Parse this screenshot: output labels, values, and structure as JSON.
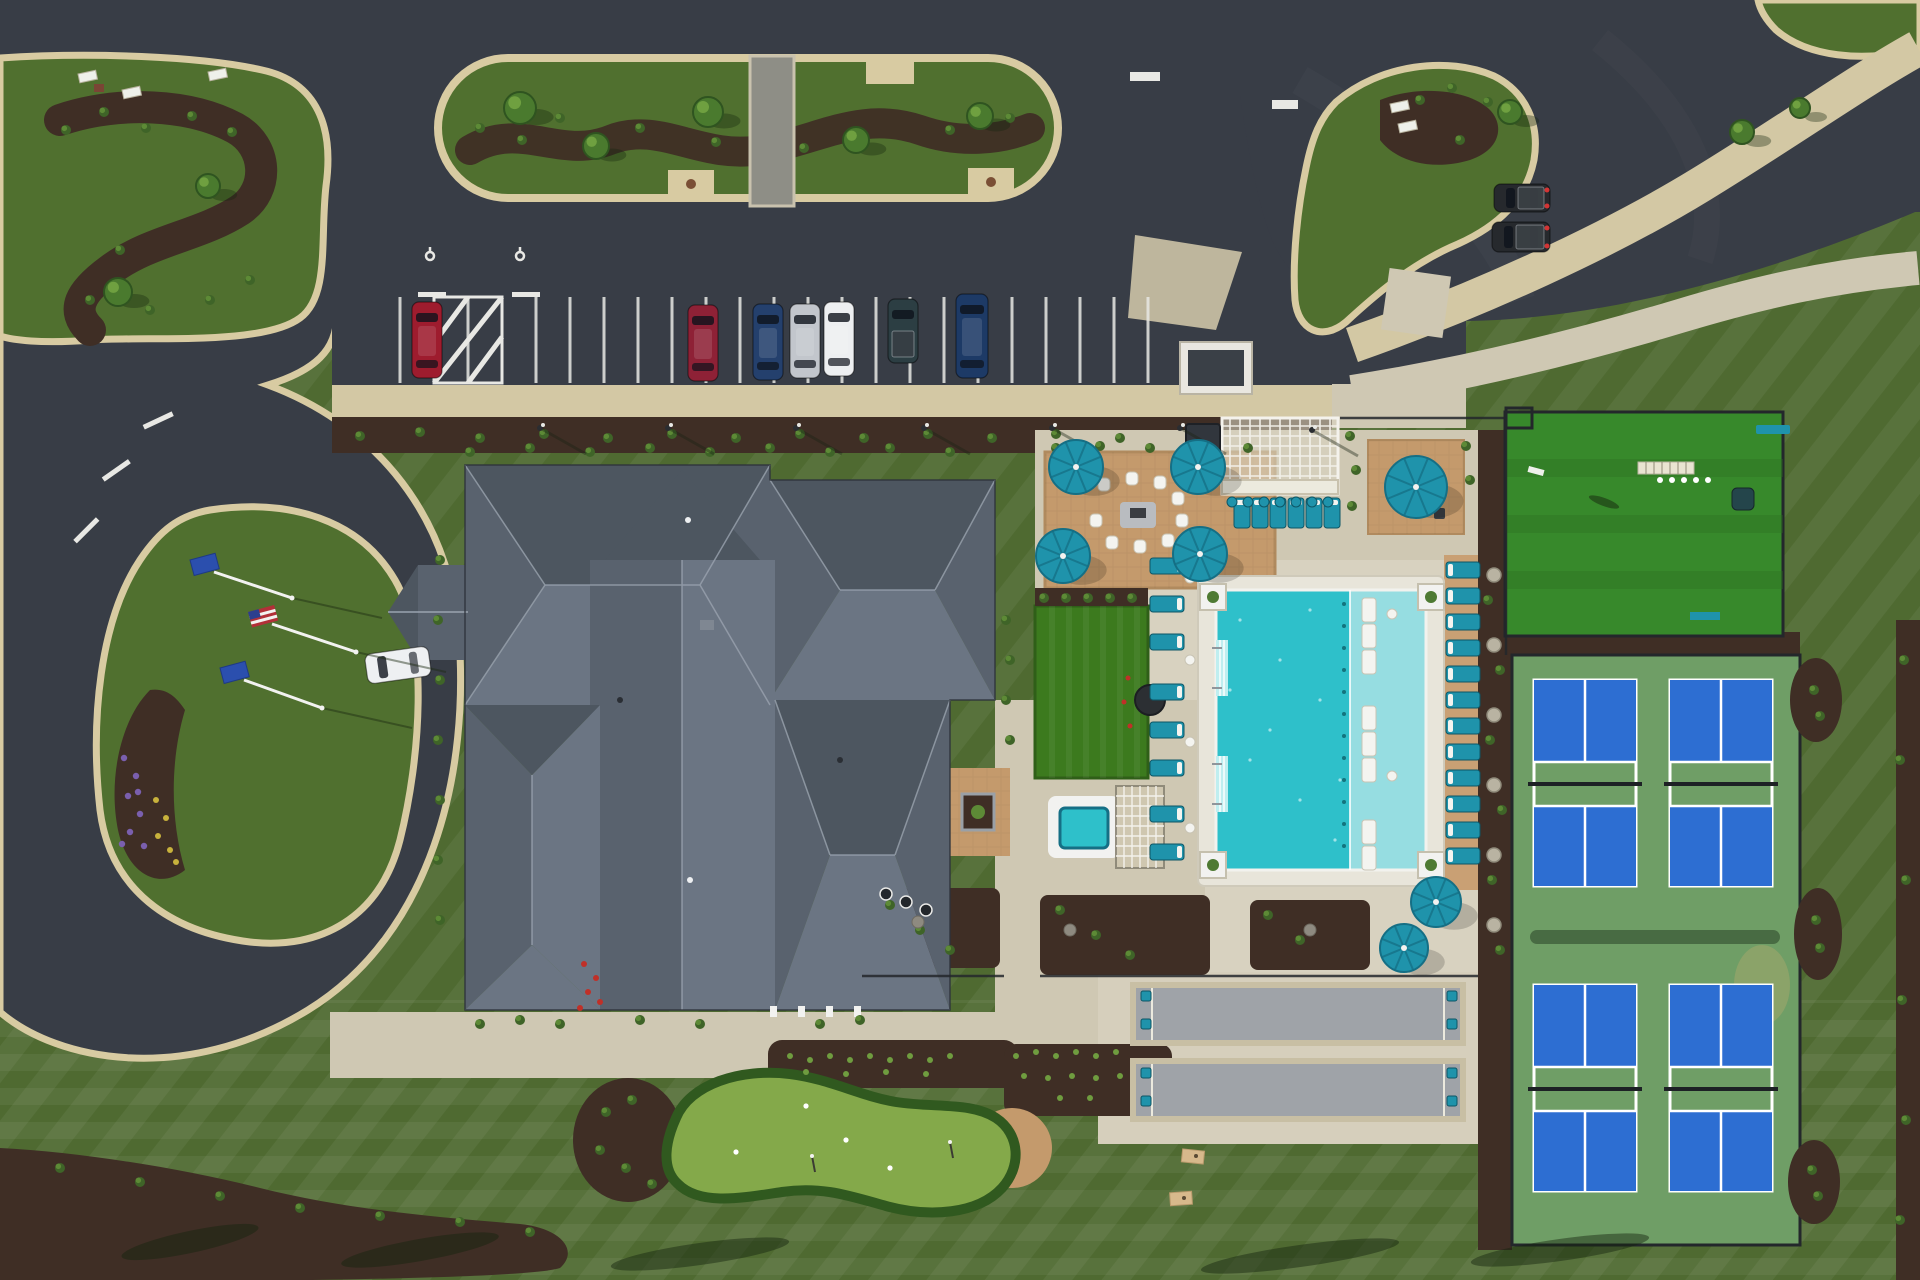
{
  "meta": {
    "title": "Aerial drone view of a community clubhouse campus with circular drive, parking lot, pool, pickleball courts, bocce courts and putting greens",
    "view": "top-down aerial photo"
  },
  "colors": {
    "lawn": "#4f6a31",
    "asphalt": "#383d46",
    "curb": "#d8cba2",
    "concrete": "#cfc8b3",
    "deck": "#e8e5da",
    "paver": "#c49a6c",
    "mulch": "#3f2e25",
    "roofN": "#4d5660",
    "roofS": "#6b7583",
    "roofSide": "#59626e",
    "roofEdge": "#2c313a",
    "ridge": "#9aa3af",
    "poolWater": "#2ec0ca",
    "poolShelf": "#96dde1",
    "teal": "#1f93ab",
    "tealDark": "#156f85",
    "courtBlue": "#2d6ed2",
    "courtGreen": "#6f9e66",
    "turf": "#37892b",
    "putting": "#84a94a",
    "puttingFringe": "#30591f",
    "bocce": "#9fa3a8",
    "fence": "#23272b",
    "white": "#f2f2f0",
    "flagBlue": "#2b4fae",
    "flagRed": "#b23038"
  },
  "counts": {
    "parked_cars": 7,
    "loose_vehicles": 3,
    "parking_stalls": 23,
    "accessible_stalls": 2,
    "flag_poles": 3,
    "patio_umbrellas": 7,
    "fire_pit_chairs": 9,
    "bar_stools": 7,
    "loungers_west": 8,
    "loungers_north": 6,
    "loungers_east": 12,
    "in_pool_loungers": 8,
    "pickleball_courts": 4,
    "bocce_courts": 2,
    "bocce_chairs": 8,
    "putting_greens": 2,
    "cornhole_boards": 2,
    "hot_tubs": 1
  },
  "inventory": {
    "parking": {
      "stalls": {
        "x0": 400,
        "pitch": 34,
        "count": 23,
        "y1": 297,
        "y2": 383,
        "hatch": [
          434,
          502
        ]
      }
    },
    "cars": [
      {
        "name": "car-red",
        "x": 412,
        "y": 302,
        "w": 30,
        "h": 76,
        "color": "#9e1c2e"
      },
      {
        "name": "car-maroon",
        "x": 688,
        "y": 305,
        "w": 30,
        "h": 76,
        "color": "#8e2136"
      },
      {
        "name": "car-navy",
        "x": 753,
        "y": 304,
        "w": 30,
        "h": 76,
        "color": "#24406d"
      },
      {
        "name": "car-silver",
        "x": 790,
        "y": 304,
        "w": 30,
        "h": 74,
        "color": "#c2c6cc"
      },
      {
        "name": "car-white",
        "x": 824,
        "y": 302,
        "w": 30,
        "h": 74,
        "color": "#edeff1"
      },
      {
        "name": "pickup-dark-teal",
        "x": 888,
        "y": 299,
        "w": 30,
        "h": 64,
        "color": "#2c3e43",
        "bed": true
      },
      {
        "name": "suv-navy",
        "x": 956,
        "y": 294,
        "w": 32,
        "h": 84,
        "color": "#1d3a66"
      }
    ],
    "loose_vehicles": [
      {
        "name": "car-white-driveway",
        "x": 366,
        "y": 650,
        "w": 64,
        "h": 30,
        "color": "#eef0f2",
        "rot": -8
      },
      {
        "name": "truck-dark-1",
        "x": 1494,
        "y": 184,
        "w": 56,
        "h": 28,
        "color": "#26292d",
        "tail": true
      },
      {
        "name": "truck-dark-2",
        "x": 1492,
        "y": 222,
        "w": 58,
        "h": 30,
        "color": "#26292d",
        "tail": true
      }
    ],
    "umbrellas": [
      {
        "cx": 1076,
        "cy": 467,
        "r": 27
      },
      {
        "cx": 1198,
        "cy": 467,
        "r": 27
      },
      {
        "cx": 1063,
        "cy": 556,
        "r": 27
      },
      {
        "cx": 1200,
        "cy": 554,
        "r": 27
      },
      {
        "cx": 1416,
        "cy": 487,
        "r": 31
      },
      {
        "cx": 1436,
        "cy": 902,
        "r": 25
      },
      {
        "cx": 1404,
        "cy": 948,
        "r": 24
      }
    ],
    "flags": [
      {
        "type": "blue",
        "x1": 214,
        "y1": 572,
        "x2": 292,
        "y2": 598
      },
      {
        "type": "usa",
        "x1": 272,
        "y1": 624,
        "x2": 356,
        "y2": 652
      },
      {
        "type": "blue",
        "x1": 244,
        "y1": 680,
        "x2": 322,
        "y2": 708
      }
    ],
    "lounger_groups": [
      {
        "name": "loungers-west",
        "x": 1150,
        "w": 34,
        "h": 16,
        "pillow": "e",
        "ys": [
          558,
          596,
          634,
          684,
          722,
          760,
          806,
          844
        ]
      },
      {
        "name": "loungers-east",
        "x": 1446,
        "w": 34,
        "h": 16,
        "pillow": "w",
        "ys": [
          562,
          588,
          614,
          640,
          666,
          692,
          718,
          744,
          770,
          796,
          822,
          848
        ]
      }
    ],
    "loungers_north": {
      "y": 498,
      "w": 16,
      "h": 30,
      "xs": [
        1234,
        1252,
        1270,
        1288,
        1306,
        1324
      ]
    },
    "pool_loungers": {
      "x": 1362,
      "w": 14,
      "h": 24,
      "ys": [
        598,
        624,
        650,
        706,
        732,
        758,
        820,
        846
      ]
    },
    "fire_chairs": [
      [
        1098,
        478
      ],
      [
        1126,
        472
      ],
      [
        1154,
        476
      ],
      [
        1172,
        492
      ],
      [
        1176,
        514
      ],
      [
        1162,
        534
      ],
      [
        1134,
        540
      ],
      [
        1106,
        536
      ],
      [
        1090,
        514
      ]
    ],
    "bar_stools": [
      [
        1232,
        502
      ],
      [
        1248,
        502
      ],
      [
        1264,
        502
      ],
      [
        1280,
        502
      ],
      [
        1296,
        502
      ],
      [
        1312,
        502
      ],
      [
        1328,
        502
      ]
    ],
    "bocce_chairs": [
      [
        1141,
        991
      ],
      [
        1141,
        1019
      ],
      [
        1447,
        991
      ],
      [
        1447,
        1019
      ],
      [
        1141,
        1068
      ],
      [
        1141,
        1096
      ],
      [
        1447,
        1068
      ],
      [
        1447,
        1096
      ]
    ],
    "ne_patio_chairs": [
      [
        1392,
        466
      ],
      [
        1434,
        508
      ]
    ],
    "side_tables_west": [
      [
        1190,
        578
      ],
      [
        1190,
        660
      ],
      [
        1190,
        742
      ],
      [
        1190,
        828
      ]
    ],
    "side_tables_pool": [
      [
        1392,
        614
      ],
      [
        1392,
        776
      ]
    ],
    "stepping_stones": [
      [
        1494,
        575
      ],
      [
        1494,
        645
      ],
      [
        1494,
        715
      ],
      [
        1494,
        785
      ],
      [
        1494,
        855
      ],
      [
        1494,
        925
      ]
    ],
    "boulders": [
      [
        918,
        922
      ],
      [
        1070,
        930
      ],
      [
        1310,
        930
      ]
    ],
    "golf_balls_green": [
      [
        806,
        1106
      ],
      [
        846,
        1140
      ],
      [
        890,
        1168
      ],
      [
        736,
        1152
      ]
    ],
    "flag_sticks_green": [
      [
        812,
        1156
      ],
      [
        950,
        1142
      ]
    ],
    "golf_balls_turf": [
      [
        1660,
        480
      ],
      [
        1672,
        480
      ],
      [
        1684,
        480
      ],
      [
        1696,
        480
      ],
      [
        1708,
        480
      ]
    ],
    "flowers": {
      "purple": [
        [
          124,
          758
        ],
        [
          136,
          776
        ],
        [
          128,
          796
        ],
        [
          140,
          814
        ],
        [
          130,
          832
        ],
        [
          144,
          846
        ],
        [
          122,
          844
        ],
        [
          138,
          792
        ]
      ],
      "yellow": [
        [
          156,
          800
        ],
        [
          166,
          818
        ],
        [
          158,
          836
        ],
        [
          170,
          850
        ],
        [
          176,
          862
        ]
      ],
      "red_building": [
        [
          584,
          964
        ],
        [
          596,
          978
        ],
        [
          588,
          992
        ],
        [
          600,
          1002
        ],
        [
          580,
          1008
        ]
      ],
      "red_lawn": [
        [
          1128,
          678
        ],
        [
          1124,
          702
        ],
        [
          1130,
          726
        ]
      ]
    },
    "light_poles": [
      [
        540,
        428
      ],
      [
        668,
        428
      ],
      [
        796,
        428
      ],
      [
        924,
        428
      ],
      [
        1052,
        428
      ],
      [
        1180,
        428
      ],
      [
        1312,
        430
      ]
    ],
    "signs_white": [
      [
        78,
        74
      ],
      [
        122,
        90
      ],
      [
        208,
        72
      ],
      [
        1390,
        104
      ],
      [
        1398,
        124
      ]
    ],
    "sparkles": [
      [
        1240,
        620
      ],
      [
        1280,
        660
      ],
      [
        1320,
        700
      ],
      [
        1250,
        760
      ],
      [
        1300,
        800
      ],
      [
        1335,
        840
      ],
      [
        1230,
        690
      ],
      [
        1270,
        730
      ],
      [
        1310,
        610
      ],
      [
        1340,
        780
      ]
    ],
    "shrubs": [
      [
        480,
        128
      ],
      [
        522,
        140
      ],
      [
        560,
        118
      ],
      [
        598,
        150
      ],
      [
        640,
        128
      ],
      [
        716,
        142
      ],
      [
        804,
        148
      ],
      [
        950,
        130
      ],
      [
        1010,
        118
      ],
      [
        66,
        130
      ],
      [
        104,
        112
      ],
      [
        146,
        128
      ],
      [
        192,
        116
      ],
      [
        232,
        132
      ],
      [
        120,
        250
      ],
      [
        90,
        300
      ],
      [
        150,
        310
      ],
      [
        210,
        300
      ],
      [
        250,
        280
      ],
      [
        360,
        436
      ],
      [
        420,
        432
      ],
      [
        480,
        438
      ],
      [
        544,
        434
      ],
      [
        608,
        438
      ],
      [
        672,
        434
      ],
      [
        736,
        438
      ],
      [
        800,
        434
      ],
      [
        864,
        438
      ],
      [
        928,
        434
      ],
      [
        992,
        438
      ],
      [
        1056,
        434
      ],
      [
        1120,
        438
      ],
      [
        1420,
        100
      ],
      [
        1452,
        88
      ],
      [
        1488,
        102
      ],
      [
        1460,
        140
      ],
      [
        1350,
        436
      ],
      [
        1356,
        470
      ],
      [
        1352,
        506
      ],
      [
        1466,
        446
      ],
      [
        1470,
        480
      ],
      [
        1056,
        448
      ],
      [
        1100,
        446
      ],
      [
        1150,
        448
      ],
      [
        1200,
        446
      ],
      [
        1248,
        448
      ],
      [
        1044,
        598
      ],
      [
        1066,
        598
      ],
      [
        1088,
        598
      ],
      [
        1110,
        598
      ],
      [
        1132,
        598
      ],
      [
        1488,
        600
      ],
      [
        1500,
        670
      ],
      [
        1490,
        740
      ],
      [
        1502,
        810
      ],
      [
        1492,
        880
      ],
      [
        1500,
        950
      ],
      [
        890,
        905
      ],
      [
        920,
        930
      ],
      [
        950,
        950
      ],
      [
        1060,
        910
      ],
      [
        1096,
        935
      ],
      [
        1130,
        955
      ],
      [
        1268,
        915
      ],
      [
        1300,
        940
      ],
      [
        470,
        452
      ],
      [
        530,
        448
      ],
      [
        590,
        452
      ],
      [
        650,
        448
      ],
      [
        710,
        452
      ],
      [
        770,
        448
      ],
      [
        830,
        452
      ],
      [
        890,
        448
      ],
      [
        950,
        452
      ],
      [
        440,
        560
      ],
      [
        438,
        620
      ],
      [
        440,
        680
      ],
      [
        438,
        740
      ],
      [
        440,
        800
      ],
      [
        438,
        860
      ],
      [
        440,
        920
      ],
      [
        1006,
        620
      ],
      [
        1010,
        660
      ],
      [
        1006,
        700
      ],
      [
        1010,
        740
      ],
      [
        480,
        1024
      ],
      [
        520,
        1020
      ],
      [
        560,
        1024
      ],
      [
        640,
        1020
      ],
      [
        700,
        1024
      ],
      [
        820,
        1024
      ],
      [
        860,
        1020
      ],
      [
        606,
        1112
      ],
      [
        632,
        1100
      ],
      [
        600,
        1150
      ],
      [
        626,
        1168
      ],
      [
        652,
        1184
      ],
      [
        60,
        1168
      ],
      [
        140,
        1182
      ],
      [
        220,
        1196
      ],
      [
        300,
        1208
      ],
      [
        380,
        1216
      ],
      [
        460,
        1222
      ],
      [
        530,
        1232
      ],
      [
        1814,
        690
      ],
      [
        1820,
        716
      ],
      [
        1816,
        920
      ],
      [
        1820,
        948
      ],
      [
        1812,
        1170
      ],
      [
        1818,
        1196
      ],
      [
        1904,
        660
      ],
      [
        1900,
        760
      ],
      [
        1906,
        880
      ],
      [
        1902,
        1000
      ],
      [
        1906,
        1120
      ],
      [
        1900,
        1220
      ]
    ],
    "plant_rows": [
      [
        790,
        1056
      ],
      [
        810,
        1060
      ],
      [
        830,
        1056
      ],
      [
        850,
        1060
      ],
      [
        870,
        1056
      ],
      [
        890,
        1060
      ],
      [
        910,
        1056
      ],
      [
        930,
        1060
      ],
      [
        950,
        1056
      ],
      [
        806,
        1072
      ],
      [
        846,
        1074
      ],
      [
        886,
        1072
      ],
      [
        926,
        1074
      ],
      [
        1016,
        1056
      ],
      [
        1036,
        1052
      ],
      [
        1056,
        1056
      ],
      [
        1076,
        1052
      ],
      [
        1096,
        1056
      ],
      [
        1116,
        1052
      ],
      [
        1024,
        1076
      ],
      [
        1048,
        1078
      ],
      [
        1072,
        1076
      ],
      [
        1096,
        1078
      ],
      [
        1120,
        1076
      ],
      [
        1060,
        1098
      ],
      [
        1090,
        1098
      ]
    ],
    "trees": [
      [
        520,
        108,
        16
      ],
      [
        596,
        146,
        13
      ],
      [
        708,
        112,
        15
      ],
      [
        856,
        140,
        13
      ],
      [
        980,
        116,
        13
      ],
      [
        118,
        292,
        14
      ],
      [
        208,
        186,
        12
      ],
      [
        1510,
        112,
        12
      ],
      [
        1742,
        132,
        12
      ],
      [
        1800,
        108,
        10
      ]
    ]
  }
}
